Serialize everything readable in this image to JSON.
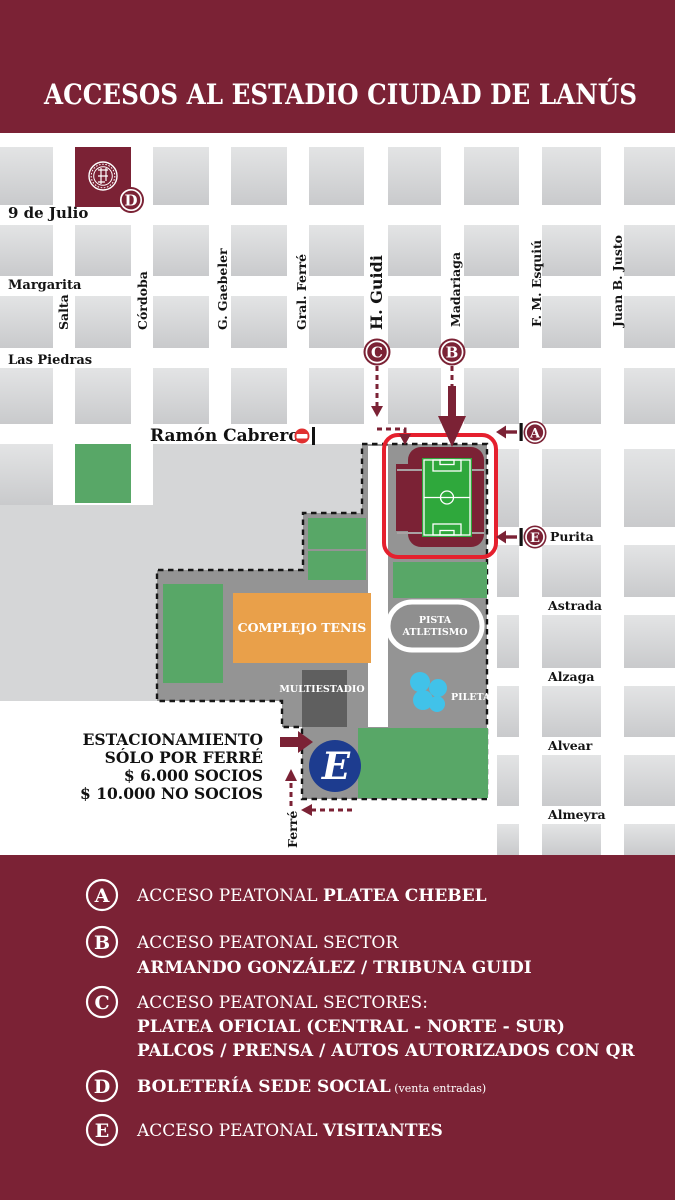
{
  "title": "ACCESOS AL ESTADIO CIUDAD DE LANÚS",
  "colors": {
    "maroon": "#7b2235",
    "field_gray": "#d5d6d7",
    "complex_gray": "#949494",
    "green": "#58a767",
    "pitch_green": "#2fa83c",
    "orange": "#e9a04a",
    "dark_gray": "#5f5f5f",
    "stadium_red": "#e5202e",
    "pool_cyan": "#41c2e9",
    "parking_blue": "#1d3c8f",
    "street_text": "#141414"
  },
  "map": {
    "h_streets": {
      "nueve_de_julio": "9 de Julio",
      "margarita": "Margarita",
      "las_piedras": "Las Piedras",
      "ramon_cabrero": "Ramón Cabrero",
      "purita": "Purita",
      "astrada": "Astrada",
      "alzaga": "Alzaga",
      "alvear": "Alvear",
      "almeyra": "Almeyra"
    },
    "v_streets": {
      "salta": "Salta",
      "cordoba": "Córdoba",
      "gaebeler": "G. Gaebeler",
      "gral_ferre": "Gral. Ferré",
      "h_guidi": "H. Guidi",
      "madariaga": "Madariaga",
      "esquiu": "F. M. Esquiú",
      "juan_b_justo": "Juan B. Justo",
      "ferre": "Ferré"
    },
    "markers": {
      "a": "A",
      "b": "B",
      "c": "C",
      "d": "D",
      "e": "E"
    },
    "facilities": {
      "complejo_tenis": "COMPLEJO TENIS",
      "multiestadio": "MULTIESTADIO",
      "pista_line1": "PISTA",
      "pista_line2": "ATLETISMO",
      "pileta": "PILETA"
    },
    "parking_lines": [
      "ESTACIONAMIENTO",
      "SÓLO POR FERRÉ",
      "$ 6.000 SOCIOS",
      "$ 10.000 NO SOCIOS"
    ],
    "parking_marker": "E"
  },
  "legend": {
    "a": {
      "letter": "A",
      "pre": "ACCESO PEATONAL ",
      "bold": "PLATEA CHEBEL"
    },
    "b": {
      "letter": "B",
      "line1": "ACCESO PEATONAL SECTOR",
      "line2": "ARMANDO GONZÁLEZ / TRIBUNA GUIDI"
    },
    "c": {
      "letter": "C",
      "line1": "ACCESO PEATONAL SECTORES:",
      "line2": "PLATEA OFICIAL (CENTRAL - NORTE - SUR)",
      "line3": "PALCOS / PRENSA / AUTOS AUTORIZADOS CON QR"
    },
    "d": {
      "letter": "D",
      "bold": "BOLETERÍA SEDE SOCIAL",
      "small": " (venta entradas)"
    },
    "e": {
      "letter": "E",
      "pre": "ACCESO PEATONAL ",
      "bold": "VISITANTES"
    }
  }
}
